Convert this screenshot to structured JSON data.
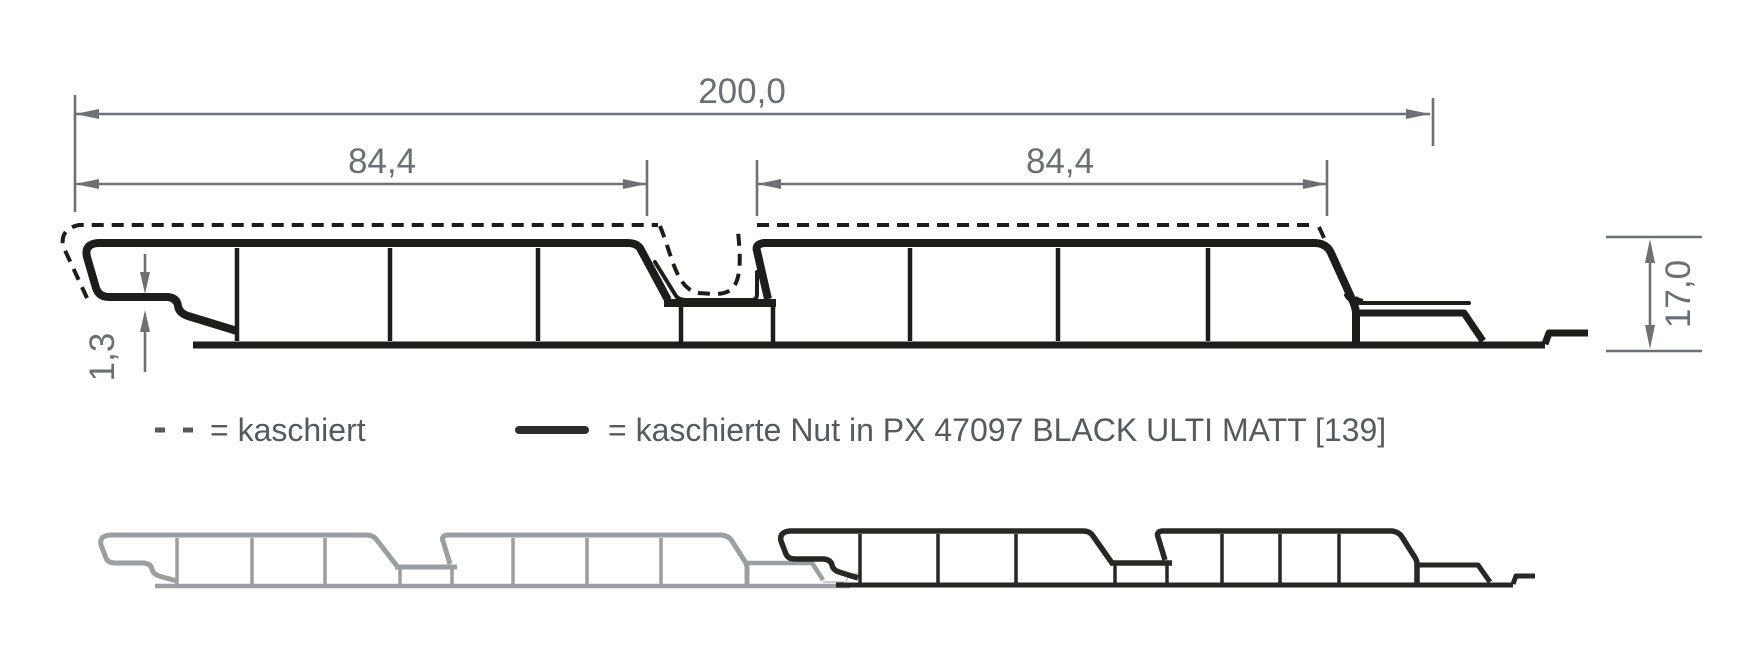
{
  "figure": {
    "type": "technical-profile-cross-section",
    "dimensions": {
      "overall_width": "200,0",
      "face_left_width": "84,4",
      "face_right_width": "84,4",
      "height": "17,0",
      "lip_thickness": "1,3"
    },
    "legend": {
      "dashed_label": "= kaschiert",
      "solid_label": "= kaschierte Nut in PX 47097 BLACK ULTI MATT [139]"
    },
    "colors": {
      "profile_line": "#1d1d1b",
      "dimension_line": "#6f7072",
      "dimension_text": "#6d6e71",
      "legend_text": "#58595b",
      "legend_dash": "#595959",
      "legend_solid": "#2d2d2d",
      "joined_panel_gray": "#9d9ea0",
      "joined_panel_black": "#272725",
      "background": "#ffffff"
    }
  }
}
